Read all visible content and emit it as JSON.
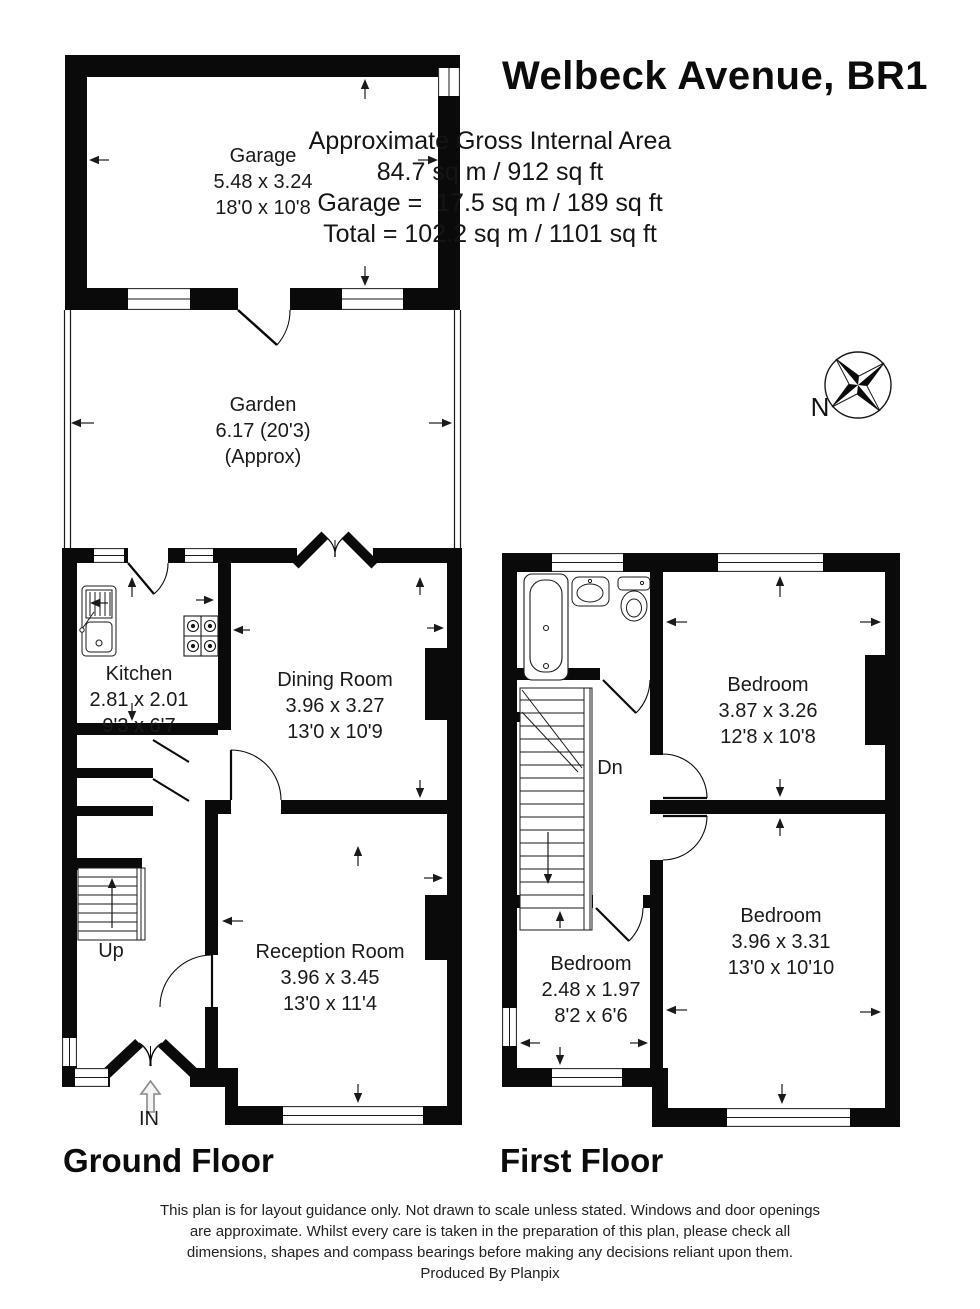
{
  "title": "Welbeck Avenue, BR1",
  "area_summary": {
    "heading": "Approximate Gross Internal Area",
    "total_internal": "84.7 sq m / 912 sq ft",
    "garage": "Garage =  17.5 sq m / 189 sq ft",
    "total": "Total = 102.2 sq m / 1101 sq ft"
  },
  "compass": {
    "label": "N"
  },
  "floors": {
    "ground": {
      "label": "Ground Floor"
    },
    "first": {
      "label": "First Floor"
    }
  },
  "rooms": {
    "garage": {
      "name": "Garage",
      "metric": "5.48 x 3.24",
      "imperial": "18'0 x 10'8"
    },
    "garden": {
      "name": "Garden",
      "metric": "6.17 (20'3)",
      "imperial": "(Approx)"
    },
    "kitchen": {
      "name": "Kitchen",
      "metric": "2.81 x 2.01",
      "imperial": "9'3 x 6'7"
    },
    "dining": {
      "name": "Dining Room",
      "metric": "3.96 x 3.27",
      "imperial": "13'0 x 10'9"
    },
    "reception": {
      "name": "Reception Room",
      "metric": "3.96 x 3.45",
      "imperial": "13'0 x 11'4"
    },
    "bedroom1": {
      "name": "Bedroom",
      "metric": "3.87 x 3.26",
      "imperial": "12'8 x 10'8"
    },
    "bedroom2": {
      "name": "Bedroom",
      "metric": "3.96 x 3.31",
      "imperial": "13'0 x 10'10"
    },
    "bedroom3": {
      "name": "Bedroom",
      "metric": "2.48 x 1.97",
      "imperial": "8'2 x 6'6"
    }
  },
  "annotations": {
    "up": "Up",
    "down": "Dn",
    "entrance": "IN"
  },
  "footer": {
    "line1": "This plan is for layout guidance only. Not drawn to scale unless stated. Windows and door openings",
    "line2": "are approximate. Whilst every care is taken in the preparation of this plan, please check all",
    "line3": "dimensions, shapes and compass bearings before making any decisions reliant upon them.",
    "credit": "Produced By Planpix"
  },
  "colors": {
    "wall": "#0a0a0a",
    "background": "#ffffff",
    "line": "#1a1a1a"
  }
}
